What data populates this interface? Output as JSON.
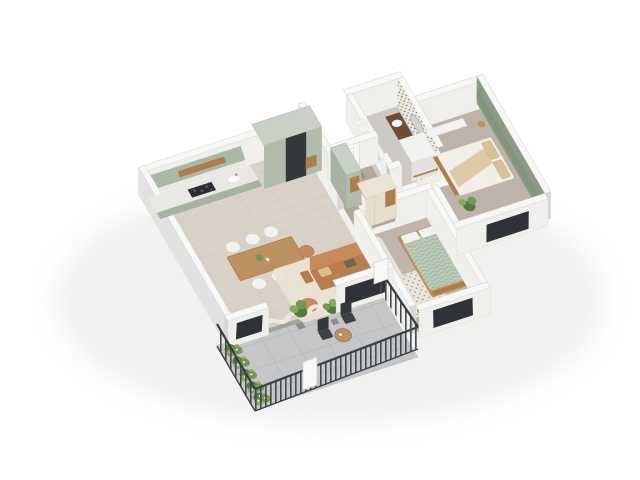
{
  "image_type": "3d-isometric-floor-plan-render",
  "background": "#ffffff",
  "palette": {
    "wall_cap": "#f7f7f5",
    "wall_face": "#efefec",
    "wall_shade": "#e2e2e0",
    "wall_shade2": "#d6d6d4",
    "wall_edge": "#d2d2d0",
    "window_dark": "#2f3337",
    "floor_living": "#d9d2c7",
    "floor_plank": "#cfc8bd",
    "floor_hall": "#b1a79d",
    "floor_bath": "#cdc9c4",
    "floor_bed2": "#c0b5aa",
    "floor_bed1": "#bdb3a9",
    "floor_balcony": "#c5c6c8",
    "balcony_tile_line": "#b6b7b9",
    "rug_cream": "#ebe4d4",
    "rug_dotted": "#e9e4da",
    "rug_dot": "#8d867a",
    "sage_cabinet": "#b0bcab",
    "sage_cabinet_dark": "#a6b2a2",
    "sage_upper": "#aab8a6",
    "sage_top": "#c9d1c4",
    "sage_accent_wall": "#8a9a84",
    "sage_accent_deep": "#7d9077",
    "duvet_green": "#abbfab",
    "duvet_line": "#cdd9c8",
    "counter_white": "#e9e8e3",
    "cooktop_black": "#2a2d31",
    "fridge_black": "#34383b",
    "wood": "#bb915f",
    "wood_dark": "#9c6b3f",
    "wood_accent": "#b07c4a",
    "sofa_caramel": "#b97c4f",
    "sofa_back": "#c68a5c",
    "cushion_tan": "#d9c08f",
    "cushion_olive": "#6e6a4f",
    "bed_white": "#f2efe8",
    "blanket_beige": "#dcc6a0",
    "pillow_beige": "#d9c29a",
    "pillow_edge": "#c5ab7f",
    "furn_white": "#f2f2f0",
    "furn_white_edge": "#dcdcda",
    "cream_wardrobe": "#e6decb",
    "cream_wardrobe_top": "#ece4d4",
    "vanity_wood": "#6b4f37",
    "mosaic_bg": "#ece8e0",
    "mosaic_dot": "#7a7066",
    "mosaic_dot2": "#9a9186",
    "railing_dark": "#454a4e",
    "railing_rail": "#3a3e42",
    "chair_dark": "#3c4145",
    "chair_dark_back": "#34383c",
    "plant_dark": "#55793f",
    "plant_mid": "#6f9a52",
    "plant_light": "#7fae5f",
    "flower_white": "#ffffff",
    "planter_wood": "#c09a6c",
    "pot_gray": "#8a8d90",
    "mat_dark": "#7d756b",
    "curtain_cream": "#efe9dc",
    "mirror_glass": "#ccd4d6",
    "shadow": "#d8d8d6"
  },
  "scene": {
    "rooms": [
      {
        "name": "kitchen-living-dining",
        "features": [
          "sage-kitchen-cabinets",
          "wood-shelf",
          "cooktop",
          "sink",
          "tall-cabinet-fridge",
          "dining-table",
          "white-chairs",
          "caramel-sofa",
          "coffee-table",
          "armchair",
          "cream-rug",
          "curtains"
        ]
      },
      {
        "name": "balcony-terrace",
        "features": [
          "metal-mesh-railing",
          "white-posts",
          "flower-planters",
          "two-dark-chairs",
          "round-table",
          "potted-plant",
          "tile-floor"
        ]
      },
      {
        "name": "entry-hall",
        "features": [
          "entry-door",
          "door-mat",
          "sage-closet-with-wood-niche",
          "cream-wardrobe"
        ]
      },
      {
        "name": "bathroom",
        "features": [
          "mosaic-wall",
          "arched-mirror",
          "dark-wood-vanity",
          "sink",
          "toilet",
          "shower-tub-block",
          "open-door"
        ]
      },
      {
        "name": "bedroom-small",
        "features": [
          "green-duvet-bed",
          "white-pillows",
          "dotted-rug",
          "white-dresser",
          "plant",
          "window-slot",
          "open-door"
        ]
      },
      {
        "name": "bedroom-master",
        "features": [
          "white-beige-bed",
          "beige-pillows",
          "sage-accent-wall",
          "wood-bench",
          "white-console",
          "plant",
          "window-slot"
        ]
      }
    ],
    "view": "isometric-dollhouse-cutaway",
    "walls": "white-cut-walls"
  }
}
